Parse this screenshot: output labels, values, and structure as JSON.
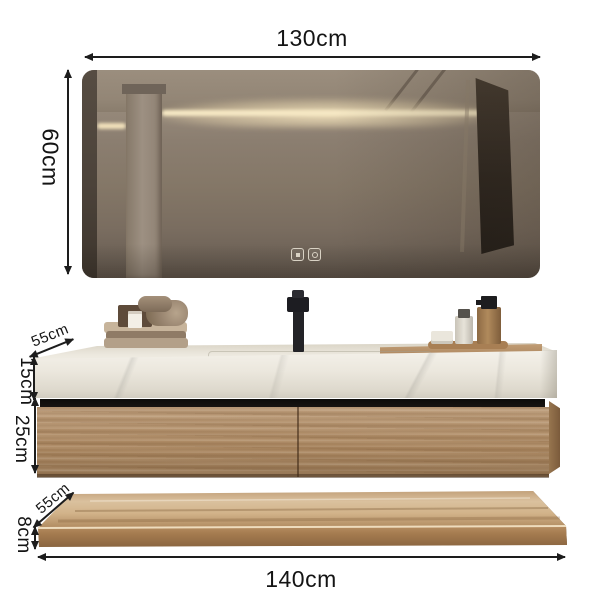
{
  "dimensions": {
    "mirror_width": "130cm",
    "mirror_height": "60cm",
    "counter_depth": "55cm",
    "counter_height": "15cm",
    "cabinet_height": "25cm",
    "shelf_depth": "55cm",
    "shelf_height": "8cm",
    "total_width": "140cm"
  },
  "icons": {
    "mirror_touch_left": "defogger-touch-icon",
    "mirror_touch_right": "light-touch-icon"
  },
  "colors": {
    "wood": "#b28d65",
    "wood_dark": "#7b5b3b",
    "marble": "#efece4",
    "mirror_wall": "#847767",
    "led_glow": "#f6e8c4",
    "label_text": "#141414"
  }
}
